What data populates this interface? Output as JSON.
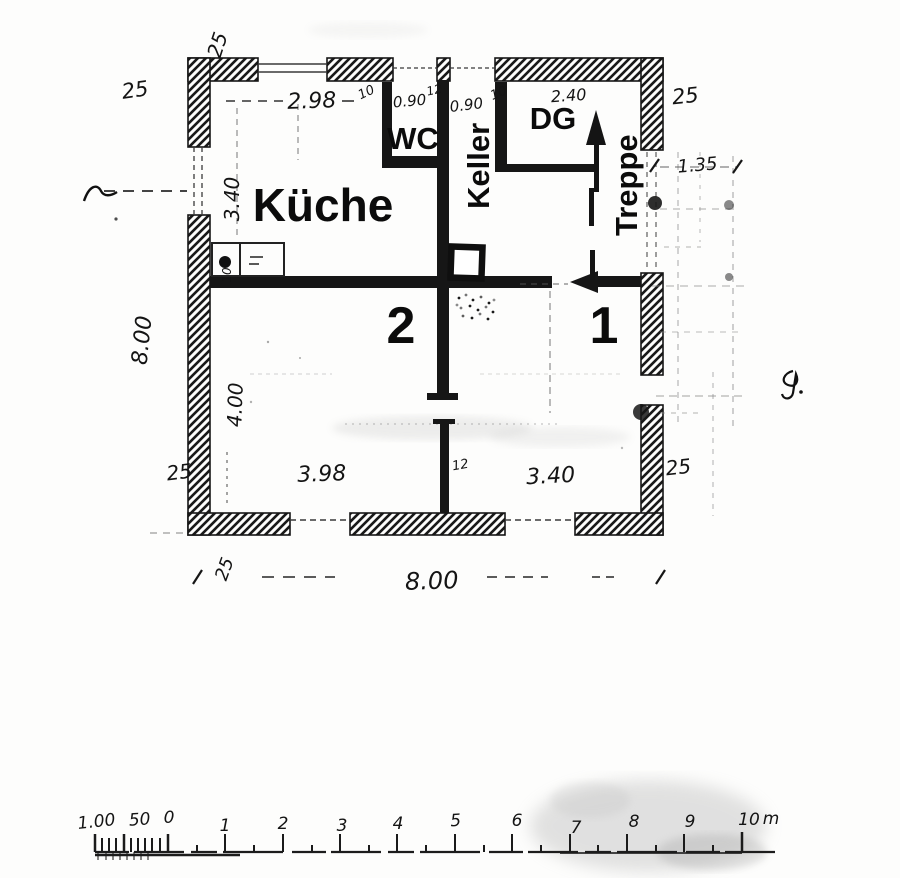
{
  "plan": {
    "room_labels": {
      "kitchen": "Küche",
      "wc": "WC",
      "cellar": "Keller",
      "attic": "DG",
      "stairs": "Treppe",
      "room_1": "1",
      "room_2": "2"
    },
    "dimensions": {
      "wall_thickness": "25",
      "kitchen_window_width": "2.98",
      "pier_left": "10",
      "wc_window_width": "0.90",
      "pier_middle": "12",
      "cellar_window_width": "0.90",
      "pier_right": "10",
      "attic_stair_width": "2.40",
      "annex_width": "1.35",
      "kitchen_depth": "3.40",
      "house_depth": "8.00",
      "counter_depth": "10",
      "lower_rooms_depth": "4.00",
      "room2_width": "3.98",
      "partition_thickness": "12",
      "room1_width": "3.40",
      "house_width": "8.00"
    }
  },
  "scale_bar": {
    "sub_labels": [
      "1.00",
      "50",
      "0"
    ],
    "major_labels": [
      "1",
      "2",
      "3",
      "4",
      "5",
      "6",
      "7",
      "8",
      "9",
      "10"
    ],
    "unit_label": "m"
  }
}
